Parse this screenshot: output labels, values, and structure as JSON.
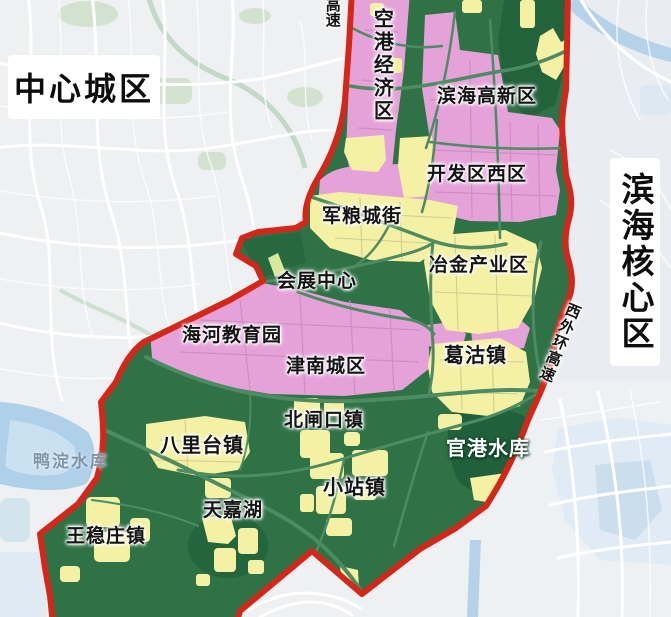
{
  "map": {
    "outside_labels": {
      "center_city": "中心城区",
      "binhai_core": "滨海核心区",
      "yadian_reservoir": "鸭淀水库",
      "expressway": "高速",
      "west_outer_ring_expressway": "西外环高速"
    },
    "zone_labels": {
      "konggang_economic": "空港经济区",
      "binhai_hightech": "滨海高新区",
      "kaifaqu_west": "开发区西区",
      "junliangcheng": "军粮城街",
      "yejin_industrial": "冶金产业区",
      "huizhan_center": "会展中心",
      "haihe_education": "海河教育园",
      "jinnan_urban": "津南城区",
      "gegu_town": "葛沽镇",
      "beizhakou_town": "北闸口镇",
      "balitai_town": "八里台镇",
      "guangang_reservoir": "官港水库",
      "xiaozhan_town": "小站镇",
      "tianjia_lake": "天嘉湖",
      "wangwenzhuang_town": "王稳庄镇"
    },
    "colors": {
      "boundary_red": "#d4271a",
      "zone_green": "#2e7245",
      "zone_dark_green": "#20603a",
      "zone_pink": "#e5a2d9",
      "zone_yellow": "#f4f1a4",
      "water_blue": "#b5d2ea",
      "outside_bg": "#eef0f2"
    }
  }
}
